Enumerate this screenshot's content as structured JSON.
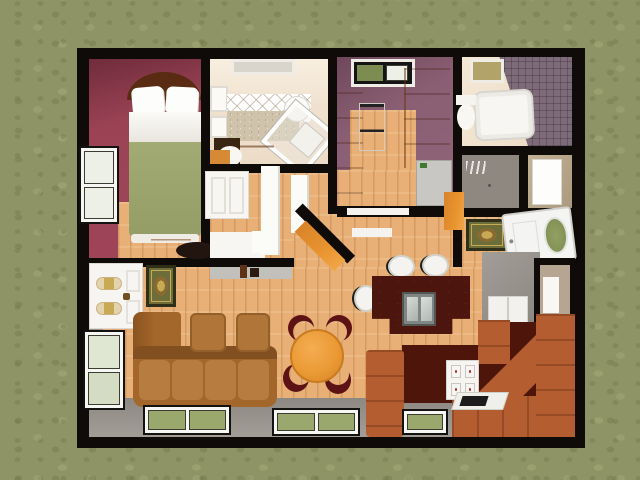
{
  "scene": {
    "description": "3D top-down dollhouse render of a small house floor plan set on mottled grass",
    "canvas": {
      "width": 640,
      "height": 480
    },
    "view": "birds-eye cutaway, thick black walls",
    "text_content": "none - the image contains no visible text, numbers or labels"
  },
  "palette": {
    "grass": "#8e9465",
    "wall": "#0e0b08",
    "wood": "#e8b076",
    "maroon": "#9b4355",
    "maroon_dark": "#7c3242",
    "plum": "#8b5f73",
    "cream": "#f0e1cf",
    "tile_mauve": "#7d6b79",
    "gray_wall": "#9b9590",
    "gray_light": "#c2c0bb",
    "tan": "#b9a78c",
    "orange": "#e8942f",
    "orange_deep": "#d9832a",
    "white_furniture": "#f6f5f1",
    "sofa_brown": "#a3662b",
    "sofa_cushion": "#b77c40",
    "rust": "#b45d30",
    "seat_dark": "#4e150b",
    "island_dark": "#4c150e",
    "steel": "#b9bfba",
    "table_orange": "#eb9a35",
    "chair_maroon": "#5d1315",
    "rug_olive": "#6d6d3a",
    "rug_border": "#30301a",
    "rug_gold": "#c8a954",
    "pane_green": "#9aa86e",
    "pane_pale": "#edf0e6",
    "blanket_green": "#9ba46d",
    "headboard_brown": "#5a2b13"
  },
  "house": {
    "rooms": [
      {
        "name": "master-bedroom",
        "position": "top-left",
        "wall_color": "#9b4355",
        "contents": [
          "double-bed-with-green-blanket",
          "two-white-pillows",
          "brown-headboard",
          "orange-dresser",
          "dark-console",
          "left-wall-window"
        ]
      },
      {
        "name": "vanity-bathroom",
        "position": "top-center-left",
        "wall_color": "#f0e1cf",
        "contents": [
          "skylight",
          "diamond-tile-backsplash",
          "granite-counter",
          "corner-glass-shower",
          "round-basin",
          "vanity-chair",
          "wall-cabinets",
          "dark-desk",
          "orange-shelf"
        ]
      },
      {
        "name": "hallway-closet",
        "position": "center-left",
        "contents": [
          "white-wardrobe",
          "three-open-door-leaves",
          "white-floor-mat",
          "diagonal-wall",
          "orange-diagonal-bench"
        ]
      },
      {
        "name": "kitchen",
        "position": "top-center",
        "wall_color": "#8b5f73",
        "contents": [
          "grass-skylight-window",
          "tall-orange-cabinet",
          "white-range",
          "orange-hutch-cabinet",
          "gray-dishwasher",
          "door-threshold"
        ]
      },
      {
        "name": "bathroom",
        "position": "top-right",
        "wall_color": "#f0e1cf",
        "contents": [
          "small-skylight",
          "mauve-tiled-wall",
          "white-bathtub",
          "toilet"
        ]
      },
      {
        "name": "closet",
        "position": "right",
        "contents": [
          "white-door-panel"
        ]
      },
      {
        "name": "utility-alcove",
        "position": "right",
        "contents": [
          "gray-appliance-panel"
        ]
      },
      {
        "name": "entry",
        "position": "right-center",
        "contents": [
          "open-white-door-with-oval-grass-window",
          "oriental-entry-rug",
          "small-orange-cabinet"
        ]
      },
      {
        "name": "utility-column",
        "position": "right-lower",
        "contents": [
          "gray-block",
          "white-cabinet-front",
          "wall-niche-with-white-fixture"
        ]
      },
      {
        "name": "living-dining-room",
        "position": "bottom",
        "wall_color": "#9b9590",
        "contents": [
          "white-dresser-with-medallion-drawers",
          "oriental-rug",
          "brown-l-sofa",
          "two-brown-ottomans",
          "round-orange-dining-table",
          "four-maroon-crescent-chairs",
          "dark-kitchen-island-with-double-sink",
          "three-white-bar-stools",
          "rust-corner-sectional",
          "white-cube-cabinet",
          "white-serving-tray",
          "three-bottom-windows",
          "left-wall-window"
        ]
      }
    ],
    "window_count": {
      "skylights": 3,
      "side_windows": 2,
      "bottom_windows": 3
    },
    "exterior": {
      "wall_color": "#0e0b08",
      "ground": "grass"
    }
  }
}
